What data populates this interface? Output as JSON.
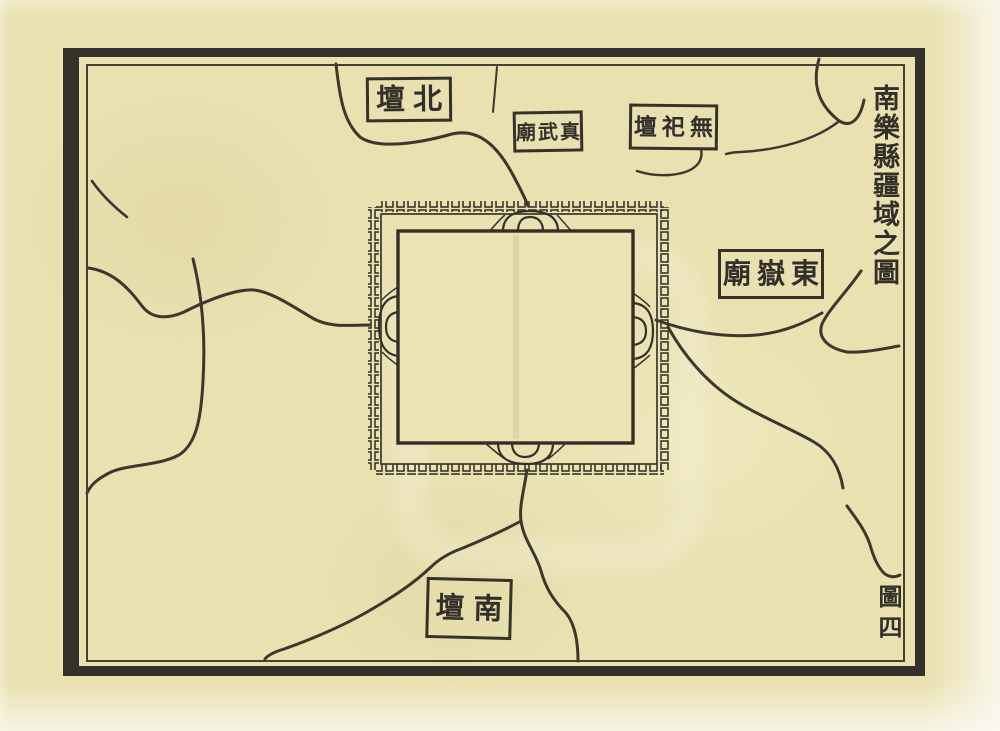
{
  "map": {
    "title": {
      "text": "南樂縣疆域之圖",
      "display": "南樂縣疆域之圖",
      "orientation": "vertical, read top-to-bottom at right margin"
    },
    "figure_number": {
      "text": "圖四",
      "display": "圖四"
    },
    "labels": [
      {
        "name": "north-altar",
        "text": "北壇",
        "display": "壇北"
      },
      {
        "name": "zhenwu-temple",
        "text": "真武廟",
        "display": "廟武真"
      },
      {
        "name": "no-sacrifice-altar",
        "text": "無祀壇",
        "display": "壇祀無"
      },
      {
        "name": "dongyue-temple",
        "text": "東嶽廟",
        "display": "廟嶽東"
      },
      {
        "name": "south-altar",
        "text": "南壇",
        "display": "壇南"
      }
    ],
    "colors": {
      "paper": "#e9e1b0",
      "ink": "#33302a"
    }
  }
}
